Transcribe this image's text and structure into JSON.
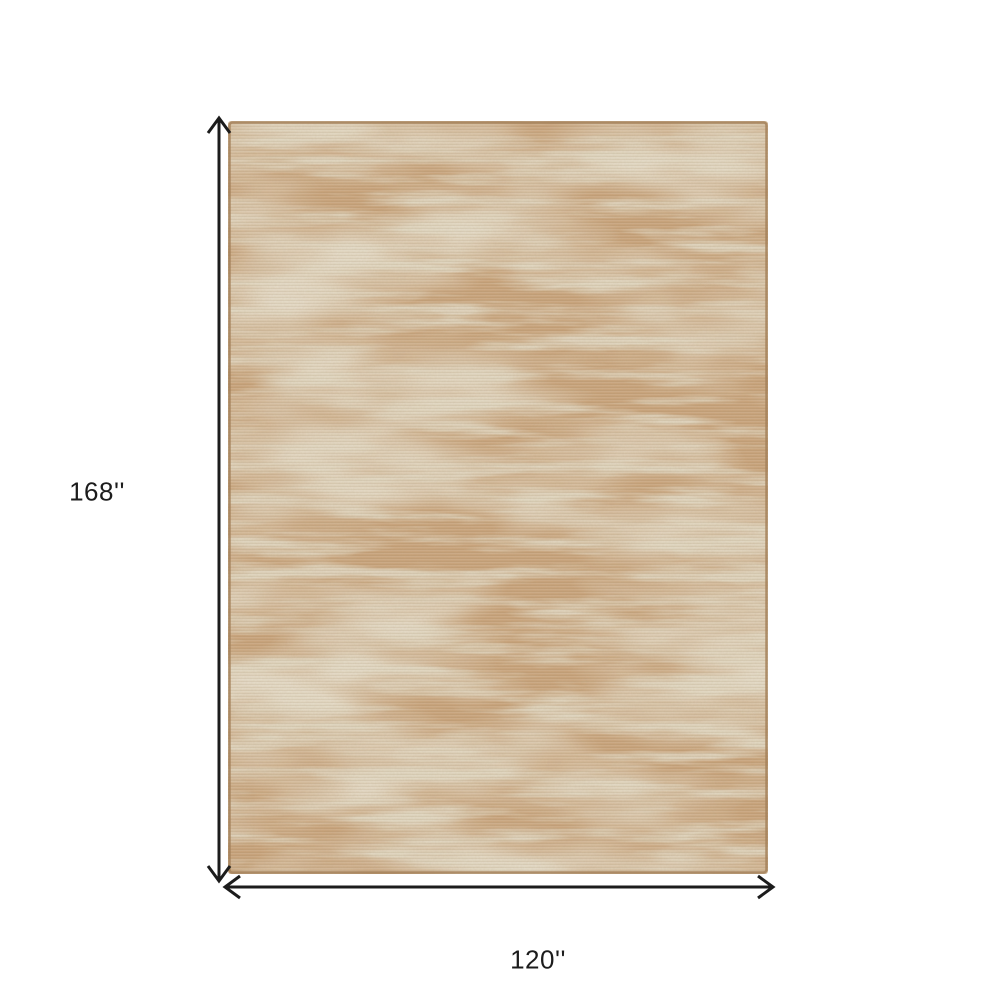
{
  "diagram": {
    "height_label": "168''",
    "width_label": "120''"
  },
  "rug": {
    "name": "distressed-abstract-area-rug",
    "aspect": "120 wide by 168 tall inches"
  },
  "colors": {
    "background": "#ffffff",
    "arrow": "#1c1c1c",
    "rug_base": "#c9a47c",
    "rug_accent": "#e7e0ce",
    "rug_accent_2": "#e2dac5",
    "rug_border": "#a5815b"
  }
}
